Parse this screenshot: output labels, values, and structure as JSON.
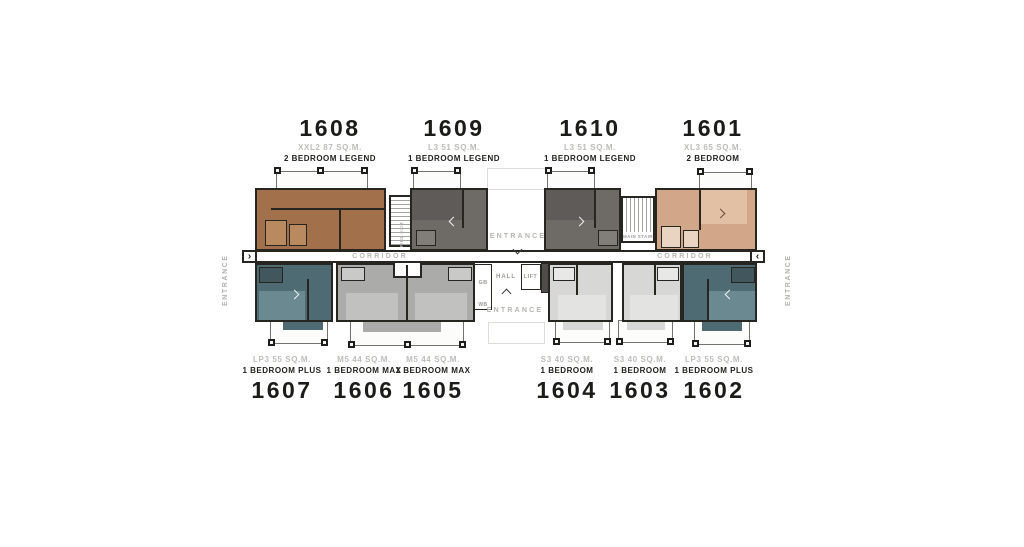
{
  "units_top": [
    {
      "number": "1608",
      "type": "XXL2 87 SQ.M.",
      "bedroom": "2 BEDROOM LEGEND",
      "color": "#a2704a"
    },
    {
      "number": "1609",
      "type": "L3 51 SQ.M.",
      "bedroom": "1 BEDROOM LEGEND",
      "color": "#6e6a66"
    },
    {
      "number": "1610",
      "type": "L3 51 SQ.M.",
      "bedroom": "1 BEDROOM LEGEND",
      "color": "#6e6a66"
    },
    {
      "number": "1601",
      "type": "XL3 65 SQ.M.",
      "bedroom": "2 BEDROOM",
      "color": "#d2a689"
    }
  ],
  "units_bottom": [
    {
      "number": "1607",
      "type": "LP3 55 SQ.M.",
      "bedroom": "1 BEDROOM PLUS",
      "color": "#4e6a72"
    },
    {
      "number": "1606",
      "type": "M5 44 SQ.M.",
      "bedroom": "1 BEDROOM MAX",
      "color": "#ababa9"
    },
    {
      "number": "1605",
      "type": "M5 44 SQ.M.",
      "bedroom": "1 BEDROOM MAX",
      "color": "#ababa9"
    },
    {
      "number": "1604",
      "type": "S3 40 SQ.M.",
      "bedroom": "1 BEDROOM",
      "color": "#d7d7d5"
    },
    {
      "number": "1603",
      "type": "S3 40 SQ.M.",
      "bedroom": "1 BEDROOM",
      "color": "#d7d7d5"
    },
    {
      "number": "1602",
      "type": "LP3 55 SQ.M.",
      "bedroom": "1 BEDROOM PLUS",
      "color": "#4e6a72"
    }
  ],
  "plan": {
    "corridor_left": "CORRIDOR",
    "corridor_right": "CORRIDOR",
    "entrance_top": "ENTRANCE",
    "entrance_bottom": "ENTRANCE",
    "entrance_left": "ENTRANCE",
    "entrance_right": "ENTRANCE",
    "hall": "HALL",
    "lift": "LIFT",
    "gb": "GB",
    "wb": "WB",
    "main_stair": "MAIN STAIR",
    "fire_exit": "FIRE EXIT",
    "arrow_left": "›",
    "arrow_right": "‹"
  }
}
